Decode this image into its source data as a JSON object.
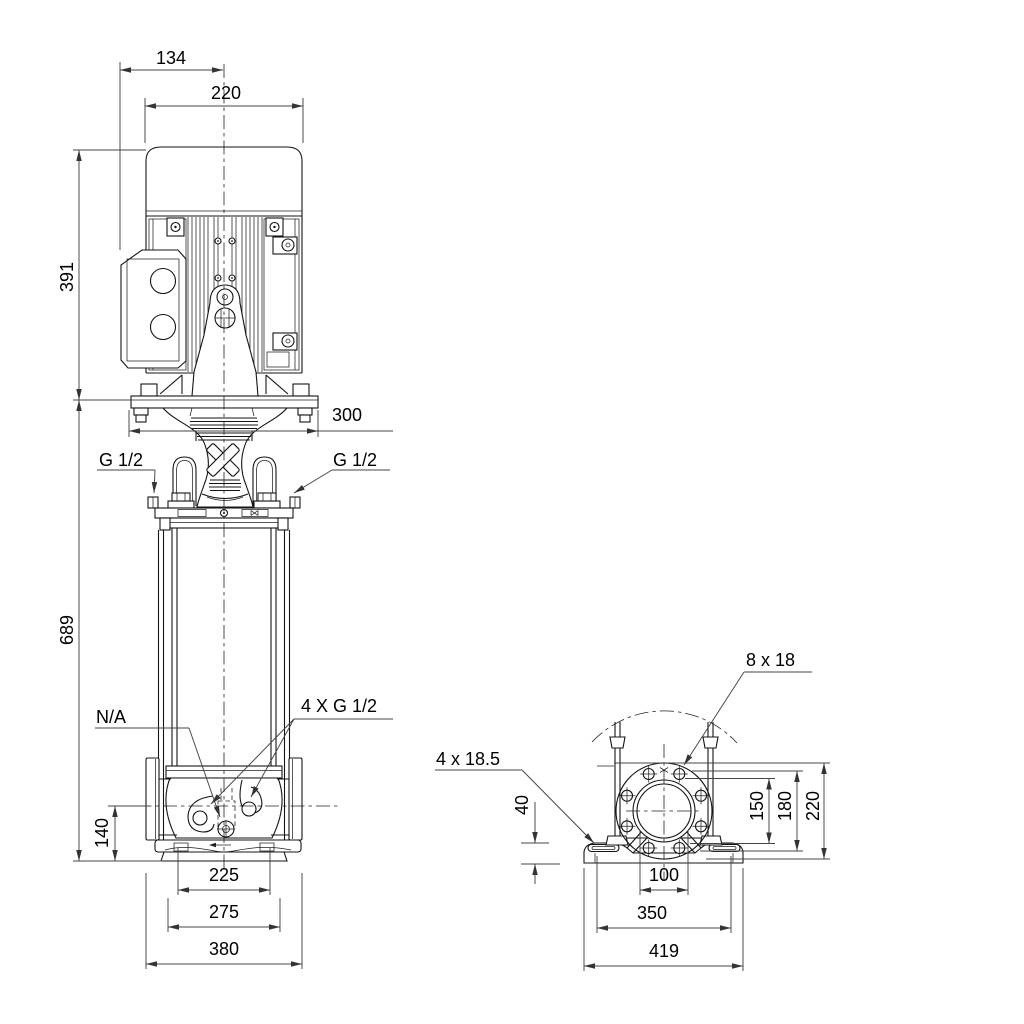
{
  "page": {
    "background": "#ffffff"
  },
  "drawing": {
    "line_color": "#141414",
    "dim_color": "#444444",
    "front_view": {
      "dims": {
        "terminal_box_offset": "134",
        "motor_width": "220",
        "motor_height": "391",
        "motor_stool_width": "300",
        "pump_height": "689",
        "port_center_height": "140",
        "chamber_width": "225",
        "foot_width": "275",
        "base_width": "380"
      },
      "labels": {
        "gauge_port_left": "G 1/2",
        "gauge_port_right": "G 1/2",
        "drain_port": "N/A",
        "pressure_ports": "4 X G 1/2"
      }
    },
    "end_view": {
      "dims": {
        "flange_bolt_holes": "8 x 18",
        "base_bolt_holes": "4 x 18.5",
        "foot_height": "40",
        "flange_face_diameter": "150",
        "flange_bolt_circle": "180",
        "flange_outer_diameter": "220",
        "port_neck_width": "100",
        "foot_hole_spacing": "350",
        "base_length": "419"
      }
    }
  }
}
